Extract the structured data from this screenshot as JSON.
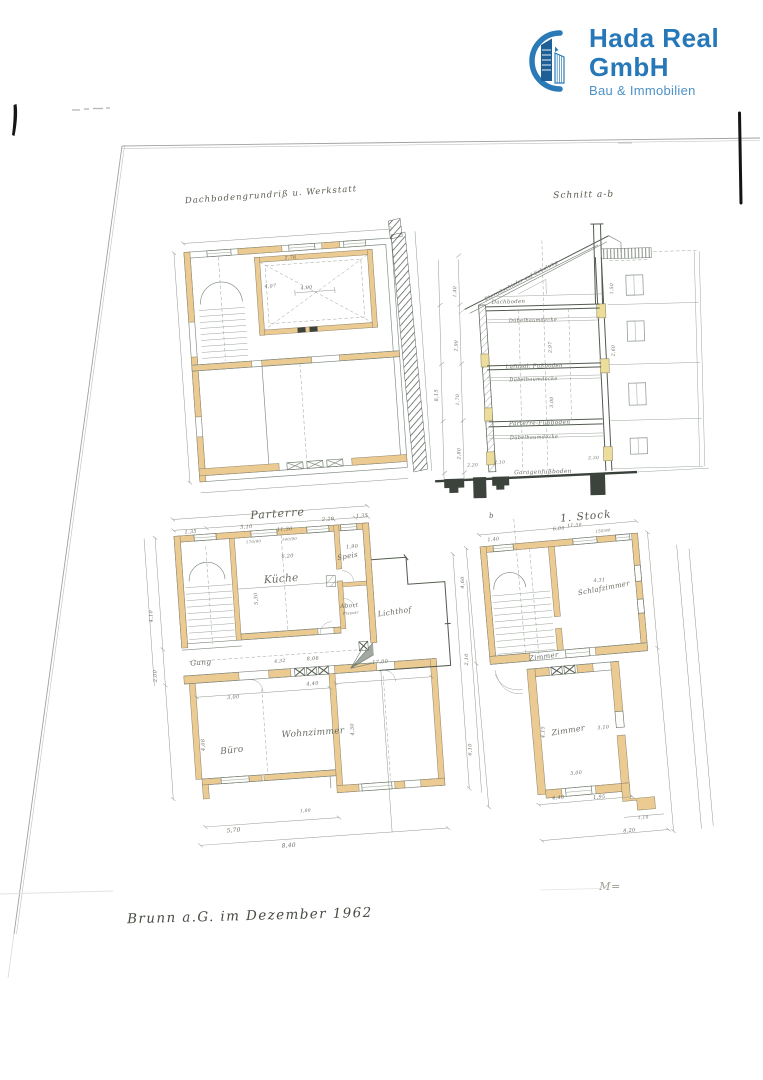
{
  "brand": {
    "name": "Hada Real GmbH",
    "tagline": "Bau & Immobilien",
    "name_color": "#2778b8",
    "tagline_color": "#4d92c6",
    "icon_dark_blue": "#1e5f96",
    "icon_mid_blue": "#2b7ab8"
  },
  "document": {
    "footer_date_note": "Brunn a.G. im Dezember 1962",
    "scale_note": "M=",
    "drawings": {
      "attic": {
        "title": "Dachbodengrundriß u. Werkstatt",
        "annotations": [
          {
            "t": "2,78",
            "x": 298,
            "y": 259,
            "s": 4.8
          },
          {
            "t": "4,07",
            "x": 276,
            "y": 286,
            "s": 4.8
          },
          {
            "t": "4,00",
            "x": 312,
            "y": 290,
            "s": 4.8
          }
        ]
      },
      "section": {
        "title": "Schnitt a-b",
        "annotations": [
          {
            "t": "Eternitschiefer auf Schalung",
            "x": 524,
            "y": 281,
            "s": 5,
            "r": -26,
            "n": "roof-note"
          },
          {
            "t": "Dachboden",
            "x": 510,
            "y": 302,
            "s": 5.4,
            "n": "floor-label"
          },
          {
            "t": "Dübelbaumdecke",
            "x": 534,
            "y": 321,
            "s": 5,
            "n": "floor-label"
          },
          {
            "t": "Luftisol. Fußboden",
            "x": 534,
            "y": 367,
            "s": 5.4,
            "n": "floor-label"
          },
          {
            "t": "Dübelbaumdecke",
            "x": 533,
            "y": 380,
            "s": 5,
            "n": "floor-label"
          },
          {
            "t": "Parterre-Fußboden",
            "x": 538,
            "y": 424,
            "s": 5.8,
            "n": "floor-label"
          },
          {
            "t": "Dübelbaumdecke",
            "x": 532,
            "y": 438,
            "s": 5,
            "n": "floor-label"
          },
          {
            "t": "Garagenfußboden",
            "x": 540,
            "y": 473,
            "s": 5.8,
            "n": "floor-label"
          },
          {
            "t": "8,15",
            "x": 437,
            "y": 392,
            "s": 5,
            "r": -90
          },
          {
            "t": "1,40",
            "x": 458,
            "y": 289,
            "s": 4.6,
            "r": -88
          },
          {
            "t": "2,90",
            "x": 458,
            "y": 343,
            "s": 4.6,
            "r": -88
          },
          {
            "t": "1,70",
            "x": 458,
            "y": 397,
            "s": 4.6,
            "r": -88
          },
          {
            "t": "2,80",
            "x": 458,
            "y": 451,
            "s": 4.6,
            "r": -88
          },
          {
            "t": "2,20",
            "x": 470,
            "y": 464,
            "s": 4.4
          },
          {
            "t": "2,10",
            "x": 497,
            "y": 462,
            "s": 4.4
          },
          {
            "t": "2,30",
            "x": 591,
            "y": 460,
            "s": 4.4
          },
          {
            "t": "1,50",
            "x": 615,
            "y": 290,
            "s": 4.6,
            "r": -88
          },
          {
            "t": "2,60",
            "x": 615,
            "y": 352,
            "s": 4.6,
            "r": -88
          },
          {
            "t": "2,97",
            "x": 552,
            "y": 347,
            "s": 4.6,
            "r": -88
          },
          {
            "t": "3,00",
            "x": 552,
            "y": 402,
            "s": 4.6,
            "r": -88
          }
        ]
      },
      "parterre": {
        "title": "Parterre",
        "annotations": [
          {
            "t": "Küche",
            "x": 289,
            "y": 581,
            "s": 10.5,
            "n": "room-label"
          },
          {
            "t": "Speis",
            "x": 357,
            "y": 562,
            "s": 7,
            "r": -6,
            "n": "room-label"
          },
          {
            "t": "Abort",
            "x": 355,
            "y": 611,
            "s": 5.8,
            "n": "room-label"
          },
          {
            "t": "Pissoir",
            "x": 356,
            "y": 618,
            "s": 4,
            "n": "room-label"
          },
          {
            "t": "Gang",
            "x": 203,
            "y": 658,
            "s": 7.5,
            "n": "room-label"
          },
          {
            "t": "Lichthof",
            "x": 400,
            "y": 621,
            "s": 7.5,
            "r": -4,
            "n": "room-label"
          },
          {
            "t": "Büro",
            "x": 228,
            "y": 748,
            "s": 9,
            "r": -3,
            "n": "room-label"
          },
          {
            "t": "Wohnzimmer",
            "x": 310,
            "y": 736,
            "s": 9,
            "n": "room-label"
          },
          {
            "t": "11,30",
            "x": 296,
            "y": 530,
            "s": 5
          },
          {
            "t": "1,35",
            "x": 202,
            "y": 526,
            "s": 5
          },
          {
            "t": "5,10",
            "x": 258,
            "y": 525,
            "s": 5
          },
          {
            "t": "2,20",
            "x": 340,
            "y": 523,
            "s": 5
          },
          {
            "t": "1,35",
            "x": 374,
            "y": 522,
            "s": 5
          },
          {
            "t": "170/90",
            "x": 264,
            "y": 540,
            "s": 3.8
          },
          {
            "t": "140/90",
            "x": 300,
            "y": 540,
            "s": 3.8
          },
          {
            "t": "6,20",
            "x": 297,
            "y": 557,
            "s": 5
          },
          {
            "t": "1,90",
            "x": 362,
            "y": 552,
            "s": 5
          },
          {
            "t": "5,30",
            "x": 264,
            "y": 596,
            "s": 5,
            "r": -88
          },
          {
            "t": "8,06",
            "x": 315,
            "y": 661,
            "s": 5
          },
          {
            "t": "4,32",
            "x": 282,
            "y": 661,
            "s": 4.6
          },
          {
            "t": "17,00",
            "x": 382,
            "y": 669,
            "s": 5
          },
          {
            "t": "3,00",
            "x": 233,
            "y": 694,
            "s": 5
          },
          {
            "t": "4,40",
            "x": 313,
            "y": 686,
            "s": 5
          },
          {
            "t": "4,08",
            "x": 201,
            "y": 738,
            "s": 5,
            "r": -88
          },
          {
            "t": "4,30",
            "x": 351,
            "y": 733,
            "s": 5,
            "r": -88
          },
          {
            "t": "1,00",
            "x": 297,
            "y": 812,
            "s": 4.4
          },
          {
            "t": "5,70",
            "x": 224,
            "y": 827,
            "s": 5.8
          },
          {
            "t": "8,40",
            "x": 278,
            "y": 846,
            "s": 5.8
          },
          {
            "t": "4,10",
            "x": 158,
            "y": 606,
            "s": 5,
            "r": -88
          },
          {
            "t": "2,00",
            "x": 158,
            "y": 666,
            "s": 5,
            "r": -88
          }
        ]
      },
      "first_floor": {
        "title": "1. Stock",
        "section_marker": "b",
        "annotations": [
          {
            "t": "11,50",
            "x": 588,
            "y": 528,
            "s": 4.6
          },
          {
            "t": "1,40",
            "x": 506,
            "y": 535,
            "s": 4.8
          },
          {
            "t": "6,00",
            "x": 572,
            "y": 530,
            "s": 4.8
          },
          {
            "t": "150/90",
            "x": 616,
            "y": 536,
            "s": 3.8
          },
          {
            "t": "Schlafzimmer",
            "x": 612,
            "y": 594,
            "s": 7,
            "r": -6,
            "n": "room-label"
          },
          {
            "t": "4,31",
            "x": 608,
            "y": 585,
            "s": 4.8
          },
          {
            "t": "Zimmer",
            "x": 546,
            "y": 657,
            "s": 7,
            "r": -3,
            "n": "room-label"
          },
          {
            "t": "Zimmer",
            "x": 564,
            "y": 733,
            "s": 8,
            "r": -4,
            "n": "room-label"
          },
          {
            "t": "4,15",
            "x": 540,
            "y": 730,
            "s": 4.8,
            "r": -85
          },
          {
            "t": "3,10",
            "x": 599,
            "y": 732,
            "s": 4.8
          },
          {
            "t": "3,00",
            "x": 568,
            "y": 775,
            "s": 4.8
          },
          {
            "t": "4,60",
            "x": 473,
            "y": 574,
            "s": 5,
            "r": -85
          },
          {
            "t": "2,10",
            "x": 470,
            "y": 651,
            "s": 5,
            "r": -85
          },
          {
            "t": "6,10",
            "x": 466,
            "y": 741,
            "s": 5,
            "r": -85
          },
          {
            "t": "4,48",
            "x": 548,
            "y": 798,
            "s": 5
          },
          {
            "t": "1,95",
            "x": 589,
            "y": 801,
            "s": 5
          },
          {
            "t": "8,20",
            "x": 616,
            "y": 837,
            "s": 5
          },
          {
            "t": "1,10",
            "x": 631,
            "y": 825,
            "s": 4.4
          }
        ]
      }
    }
  },
  "colors": {
    "wall_fill": "#eccb93",
    "wall_fill_yellow": "#ecdd9b",
    "plan_line": "#7d897e",
    "plan_line_dark": "#525b50",
    "handwriting": "#5d6257"
  }
}
